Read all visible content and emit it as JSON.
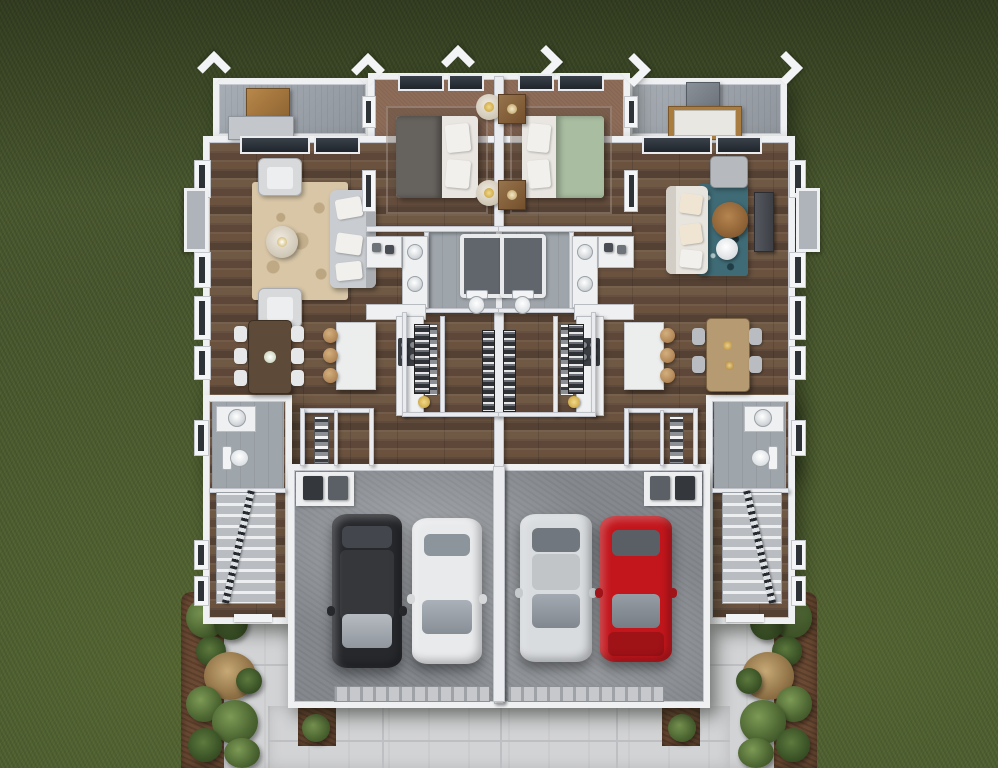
{
  "scene": {
    "view": "top-down 3D floor plan rendering",
    "building": "mirrored two-unit duplex, single story shown",
    "surroundings": "dark green lawn, concrete driveway and walkways, mulch planting beds",
    "garage_bays": 4
  },
  "palette": {
    "grass": "#49582e",
    "wood_floor": "#6a523f",
    "bedroom_carpet": "#8d6c58",
    "bathroom_tile": "#9ea5ab",
    "garage_floor": "#878c91",
    "driveway": "#d2d3d5",
    "walls": "#eef0f2",
    "deck": "#9ba1a8",
    "mulch": "#6b4a33"
  },
  "exterior": {
    "decks": [
      {
        "side": "left",
        "furniture": [
          "wood table",
          "gray bench"
        ]
      },
      {
        "side": "right",
        "furniture": [
          "storage cabinet",
          "cushioned bench"
        ]
      }
    ],
    "planting_beds": {
      "count": 2,
      "plants": [
        "green shrubs",
        "tan ornamental grasses"
      ]
    },
    "driveway_material": "concrete slabs"
  },
  "left_unit": {
    "living_room": {
      "rug": "beige floral rug",
      "rug_color": "#d8c6a6",
      "sofa_color": "#c9ccd0",
      "armchairs": 2,
      "coffee_table": "small round table"
    },
    "bedroom": {
      "duvet_color": "#66625e",
      "mattress_color": "#e9e6e1",
      "nightstands": "2 round with brass lamps"
    },
    "dining": {
      "table_color": "#5d4a38",
      "chairs": 6,
      "chair_color": "#e6e7e9",
      "centerpiece": "white flowers"
    },
    "kitchen": {
      "island_color": "#eceded",
      "stools": 3,
      "range_color": "#3b3e43",
      "pantry": "open shelving"
    },
    "bathroom": {
      "tub": 1,
      "toilet": 1,
      "vanity_sinks": 2
    },
    "walk_in_closet": {
      "clothes_rods": 2
    },
    "powder_room": {
      "toilet": 1,
      "sink": 1
    },
    "stairs": 1,
    "cars": [
      {
        "label": "black SUV",
        "color": "#26282c"
      },
      {
        "label": "white sedan",
        "color": "#e9eaec"
      }
    ]
  },
  "right_unit": {
    "living_room": {
      "rug": "teal patterned rug",
      "rug_color": "#3f6b76",
      "sofa_color": "#e8e5df",
      "chaise": 1,
      "coffee_table": "round wood table",
      "tv_console": 1
    },
    "bedroom": {
      "duvet_color": "#a9bda1",
      "mattress_color": "#e9e6e1",
      "nightstands": "2 square wood with lamps"
    },
    "dining": {
      "table_color": "#b59a72",
      "chairs": 4,
      "chair_color": "#b9bcc0",
      "decor": "gold accents"
    },
    "kitchen": {
      "island_color": "#eceded",
      "stools": 3,
      "range_color": "#3b3e43",
      "pantry": "open shelving"
    },
    "bathroom": {
      "tub": 1,
      "toilet": 1,
      "vanity_sinks": 2
    },
    "walk_in_closet": {
      "clothes_rods": 2
    },
    "powder_room": {
      "toilet": 1,
      "sink": 1
    },
    "stairs": 1,
    "cars": [
      {
        "label": "silver sedan",
        "color": "#d9dcdf"
      },
      {
        "label": "red sedan",
        "color": "#c2161c"
      }
    ]
  }
}
